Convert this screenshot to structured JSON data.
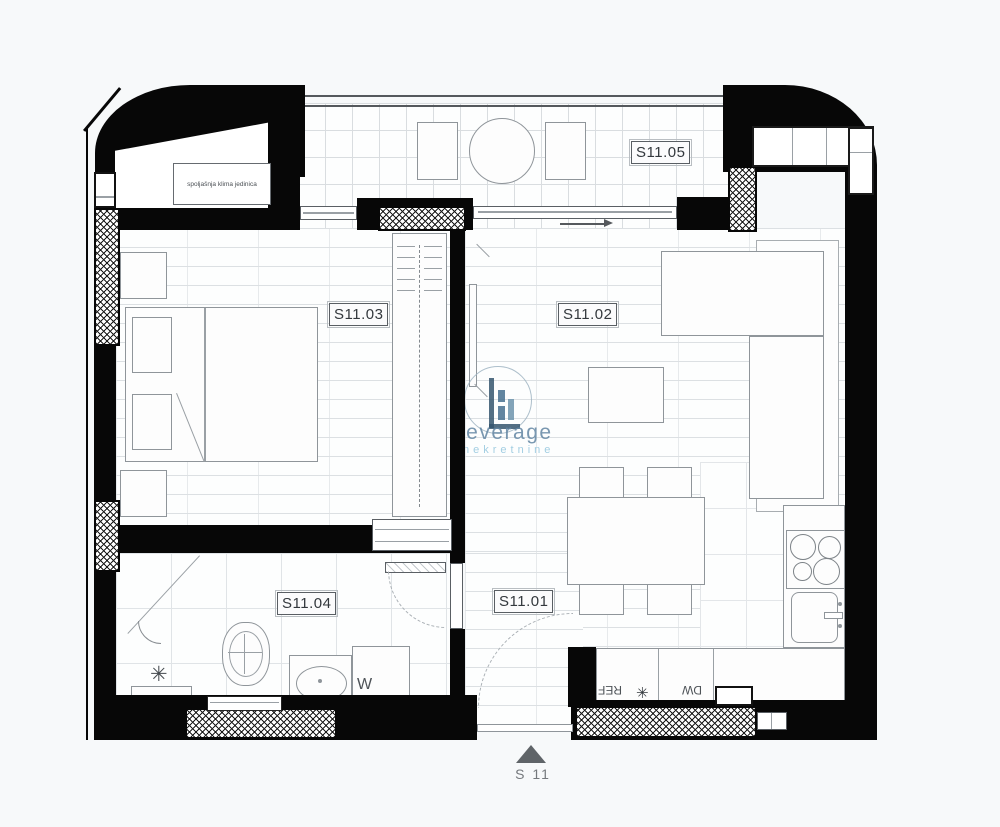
{
  "rooms": [
    {
      "id": "S11.01"
    },
    {
      "id": "S11.02"
    },
    {
      "id": "S11.03"
    },
    {
      "id": "S11.04"
    },
    {
      "id": "S11.05"
    }
  ],
  "annotations": {
    "ac_unit": "spoljašnja klima jedinica",
    "washer": "W",
    "fridge": "REF",
    "dishwasher": "DW",
    "sink_symbol": "✳",
    "shower_symbol": "✳",
    "section_marker": "S 11"
  },
  "watermark": {
    "brand": "Leverage",
    "subtitle": "nekretnine",
    "brand_color": "#6286a3",
    "subtitle_color": "#93c6de",
    "mark_color": "#35566f"
  },
  "colors": {
    "wall": "#070707",
    "floor_line": "#dce0e3",
    "furniture_line": "#8f959a",
    "label_text": "#33383d",
    "marker_gray": "#5f6468"
  }
}
